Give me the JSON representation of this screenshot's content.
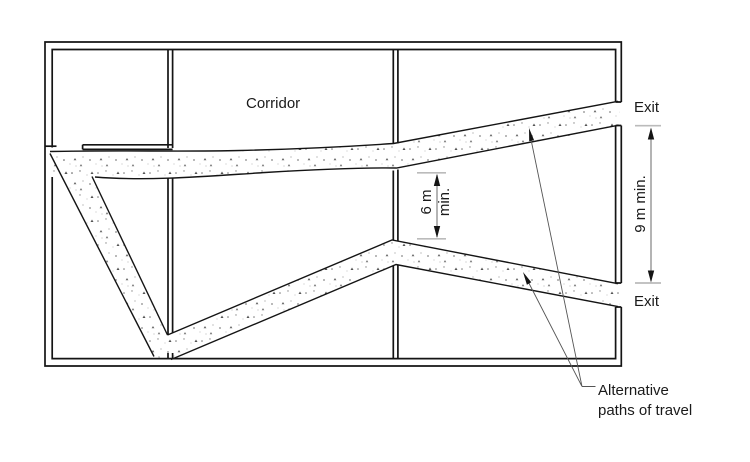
{
  "labels": {
    "corridor": "Corridor",
    "exit_top": "Exit",
    "exit_bottom": "Exit",
    "dim_6m_value": "6 m",
    "dim_6m_qualifier": "min.",
    "dim_9m": "9 m min.",
    "alt_line1": "Alternative",
    "alt_line2": "paths of travel"
  },
  "colors": {
    "line": "#141414",
    "dimension_line": "#777777",
    "extension_tick": "#bbbbbb",
    "leader_line": "#555555",
    "background": "#ffffff"
  }
}
